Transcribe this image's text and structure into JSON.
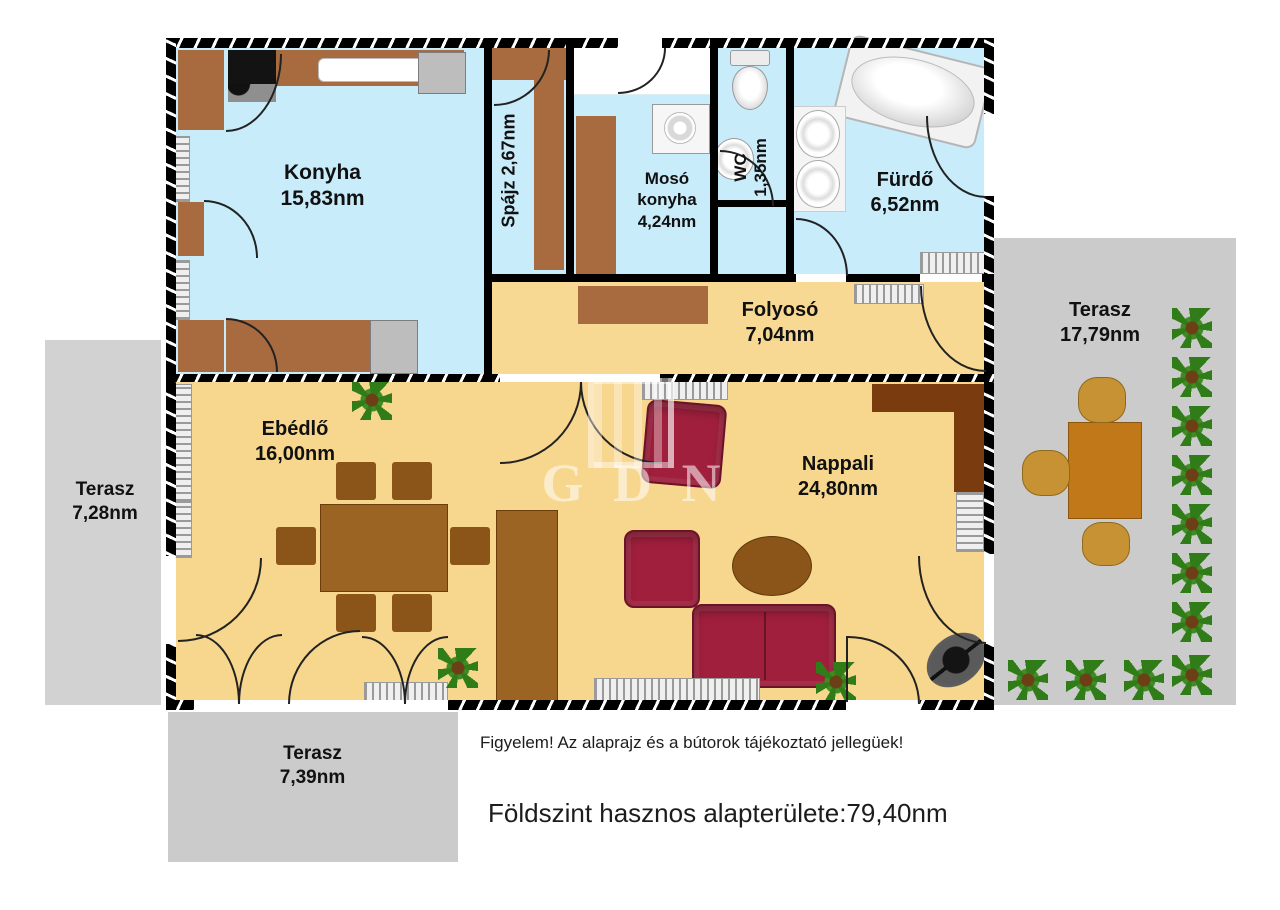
{
  "rooms": {
    "konyha": {
      "name": "Konyha",
      "area": "15,83nm"
    },
    "spajz": {
      "name": "Spájz",
      "area": "2,67nm"
    },
    "moso": {
      "name_line1": "Mosó",
      "name_line2": "konyha",
      "area": "4,24nm"
    },
    "wc": {
      "name": "WC",
      "area": "1,35nm"
    },
    "furdo": {
      "name": "Fürdő",
      "area": "6,52nm"
    },
    "folyoso": {
      "name": "Folyosó",
      "area": "7,04nm"
    },
    "ebedlo": {
      "name": "Ebédlő",
      "area": "16,00nm"
    },
    "nappali": {
      "name": "Nappali",
      "area": "24,80nm"
    }
  },
  "terraces": {
    "left": {
      "name": "Terasz",
      "area": "7,28nm"
    },
    "right": {
      "name": "Terasz",
      "area": "17,79nm"
    },
    "bottom": {
      "name": "Terasz",
      "area": "7,39nm"
    }
  },
  "watermark": {
    "letters": "G D N"
  },
  "footer": {
    "notice": "Figyelem! Az alaprajz és a bútorok tájékoztató jellegüek!",
    "total": "Földszint hasznos alapterülete:79,40nm"
  },
  "palette": {
    "wet_room_floor": "#c9ecfa",
    "living_floor": "#f7d68d",
    "hall_floor": "#f8d993",
    "wall": "#000000",
    "furniture_brown": "#a76b3f",
    "dark_cabinet_brown": "#7a3c0e",
    "table_brown": "#9c6422",
    "sofa_red": "#a01f3d",
    "terrace_gray": "#cecece",
    "terrace_table": "#c07818",
    "plant_green": "#2f7c18"
  }
}
